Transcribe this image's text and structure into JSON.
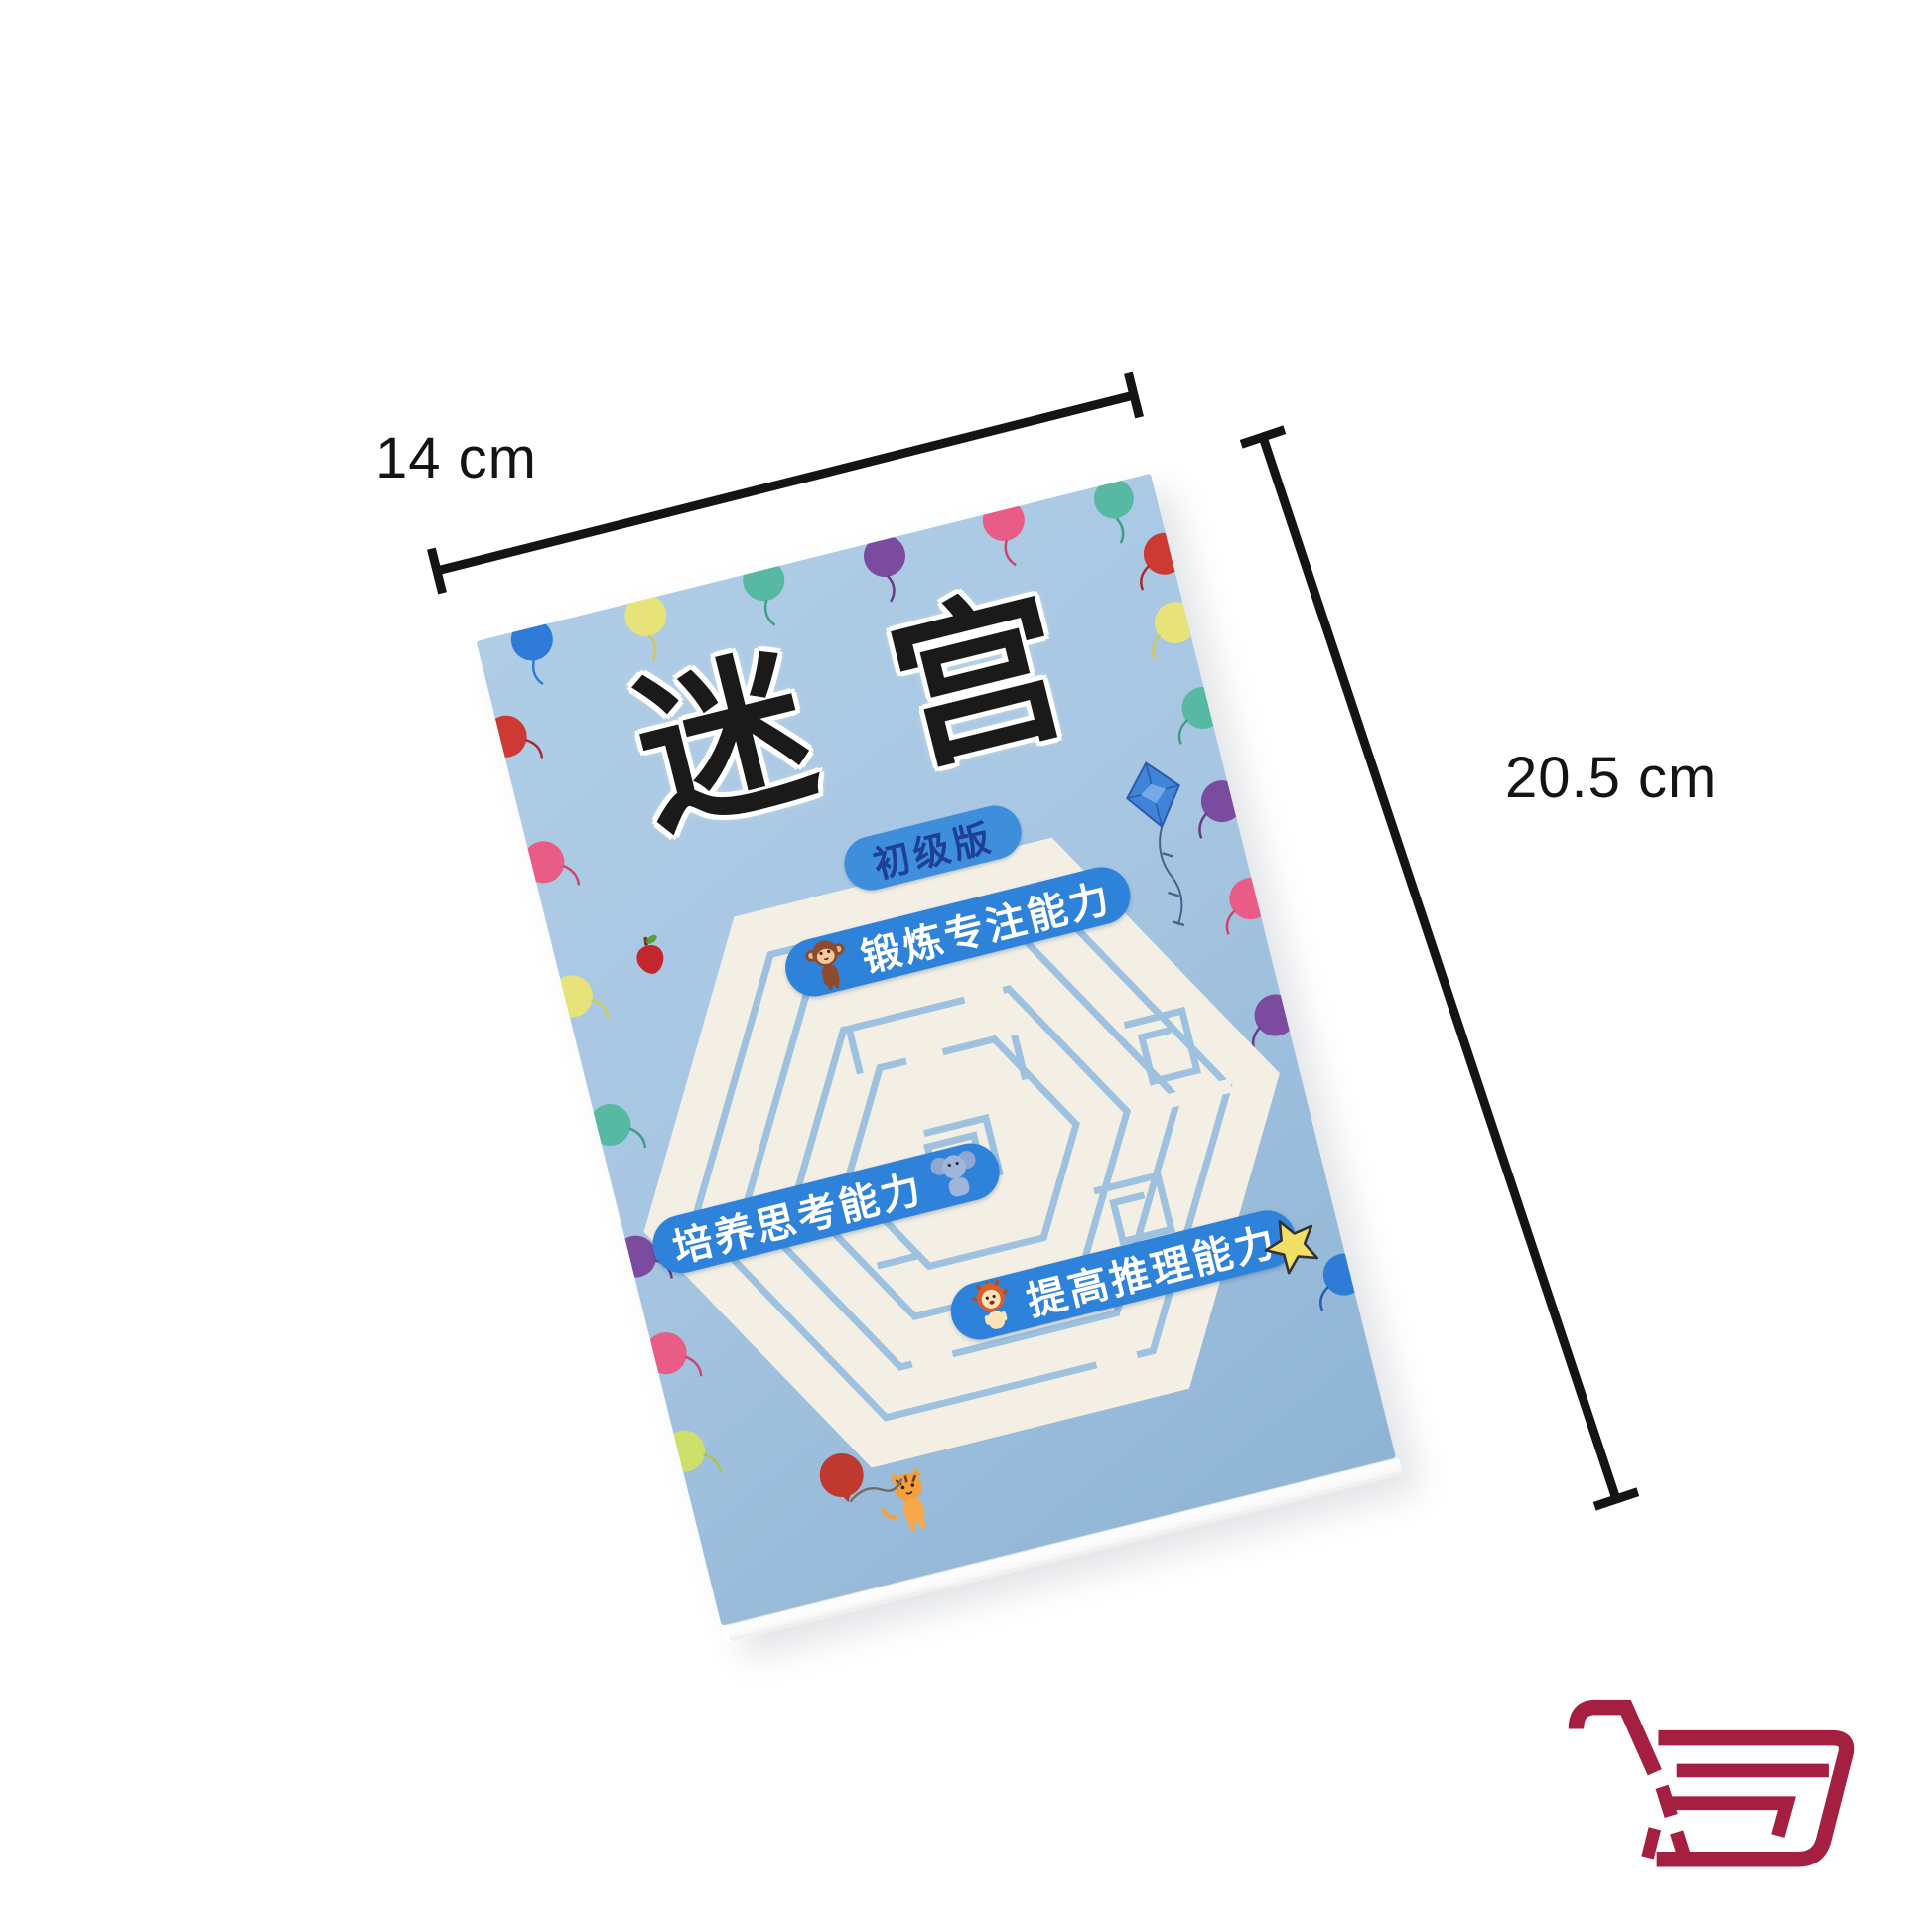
{
  "photo": {
    "description": "Product photo of a children's maze activity book lying tilted on a white background with size annotations",
    "background": "#ffffff"
  },
  "dimensions": {
    "width_label": "14 cm",
    "height_label": "20.5 cm"
  },
  "book": {
    "title": "迷宫",
    "edition_badge": "初级版",
    "feature_pills": [
      {
        "icon": "monkey-icon",
        "label": "锻炼专注能力"
      },
      {
        "icon": "elephant-icon",
        "label": "培养思考能力"
      },
      {
        "icon": "lion-icon",
        "label": "提高推理能力"
      }
    ]
  },
  "icons": {
    "logo": "shopping-cart-logo",
    "decorations": [
      "balloon",
      "kite",
      "apple",
      "star",
      "tiger",
      "hexagon-maze"
    ]
  },
  "colors": {
    "cover-blue": "#a7c6e2",
    "cover-blue-deep": "#8fb4d4",
    "maze-paper": "#f3efe5",
    "maze-line": "#9dc1df",
    "pill-blue": "#2e82d9",
    "badge-blue": "#3e8edb",
    "badge-text": "#1d3f96",
    "ink": "#141414",
    "title-ink": "#1a1a1a",
    "logo-red": "#a51f40"
  }
}
